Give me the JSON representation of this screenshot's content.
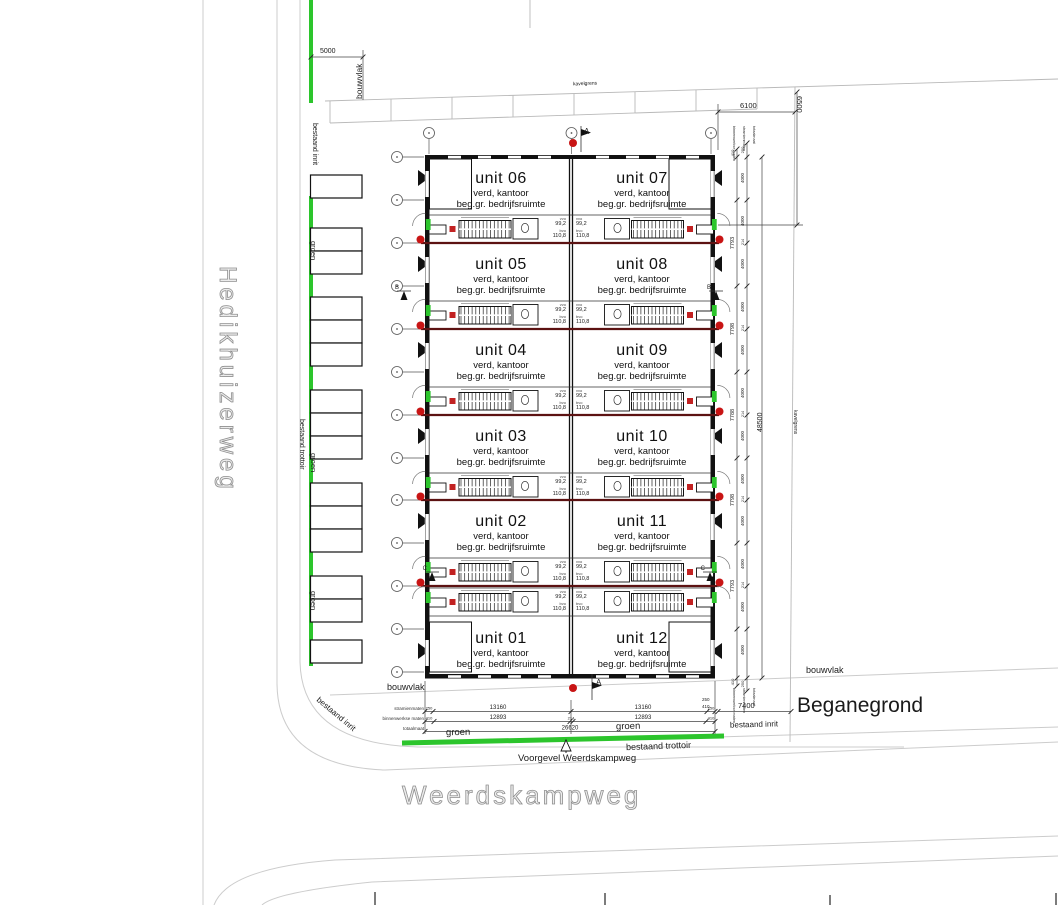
{
  "drawing": {
    "title": "Beganegrond",
    "facade_label": "Voorgevel Weerdskampweg"
  },
  "streets": {
    "left_vertical": "Hedikhuizerweg",
    "bottom_horizontal": "Weerdskampweg"
  },
  "site_labels": {
    "bouwvlak_top_left": "bouwvlak",
    "bouwvlak_bottom_left": "bouwvlak",
    "bouwvlak_bottom_right": "bouwvlak",
    "kavelgrens_top": "kavelgrens",
    "kavelgrens_right": "kavelgrens",
    "bestaand_inrit_top_left": "bestaand inrit",
    "bestaand_inrit_bottom_left": "bestaand inrit",
    "bestaand_inrit_bottom_right": "bestaand inrit",
    "bestaand_trottoir_left": "bestaand trottoir",
    "bestaand_trottoir_bottom": "bestaand trottoir",
    "groen_left": [
      "groen",
      "groen",
      "groen"
    ],
    "groen_bottom_left": "groen",
    "groen_bottom_right": "groen"
  },
  "section_markers": {
    "vertical": "A",
    "horizontal_1": "B",
    "horizontal_2": "C"
  },
  "units": {
    "floor_line1": "verd, kantoor",
    "floor_line2": "beg.gr. bedrijfsruimte",
    "area_label_top": "vvo",
    "area_label_bottom": "bvo",
    "area_top": "99,2",
    "area_bottom": "110,8",
    "pairs": [
      {
        "left": "unit 06",
        "right": "unit 07"
      },
      {
        "left": "unit 05",
        "right": "unit 08"
      },
      {
        "left": "unit 04",
        "right": "unit 09"
      },
      {
        "left": "unit 03",
        "right": "unit 10"
      },
      {
        "left": "unit 02",
        "right": "unit 11"
      },
      {
        "left": "unit 01",
        "right": "unit 12"
      }
    ]
  },
  "dimensions": {
    "top_left_width": "5000",
    "top_right_width": "6100",
    "top_right_height": "6500",
    "right_outside_total": "48500",
    "bottom_right_width": "7400",
    "right_inner_spans": [
      "7793",
      "7798",
      "7788",
      "7798",
      "7793"
    ],
    "right_wall_end": "410",
    "right_edge_end": "250",
    "grid_bay": "4000",
    "grid_wall": "214",
    "bottom_stramien": [
      "250",
      "13160",
      "13160",
      "250"
    ],
    "bottom_binnen": [
      "410",
      "12893",
      "214",
      "12893",
      "410"
    ],
    "bottom_total": "26620",
    "chain_names": {
      "binnen": "binnenwerkse maten",
      "stramien": "stramienmaten",
      "totaal": "totaalmaat"
    }
  },
  "parking": {
    "stall_count": 15
  }
}
